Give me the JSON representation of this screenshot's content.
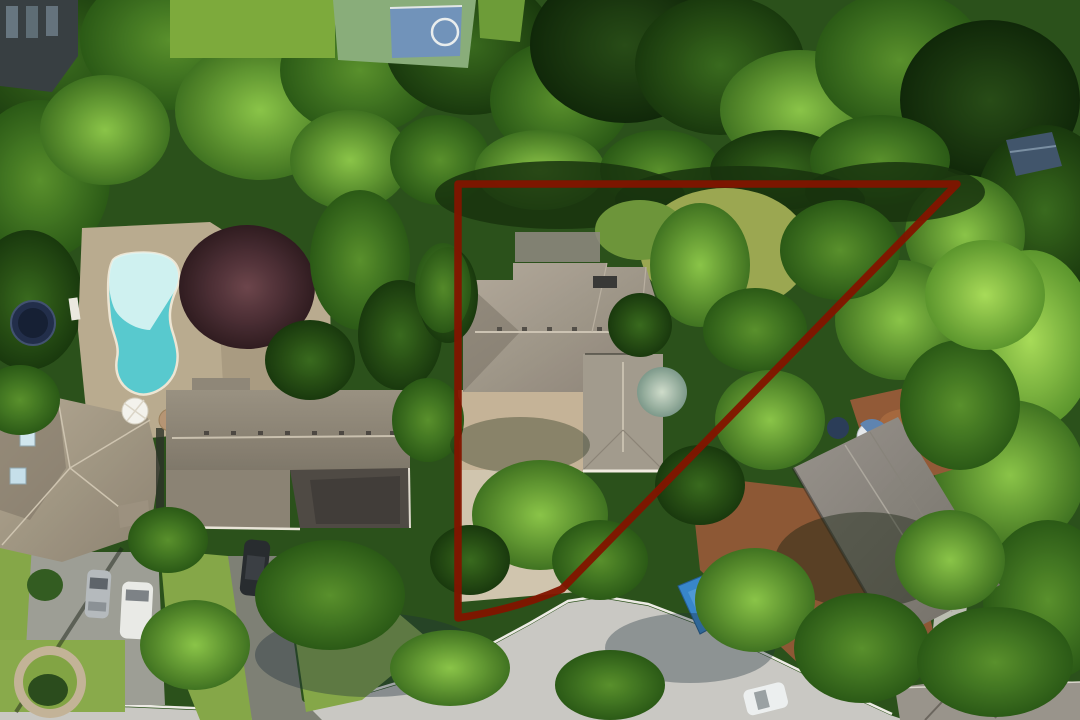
{
  "meta": {
    "description": "Aerial drone photo of a wooded suburban lot with a red property-boundary outline, a large grey-roof house inside the outline, neighbouring houses, a swimming pool, a basketball court and a cul-de-sac street"
  },
  "palette": {
    "boundary_red": "#7d1804",
    "pool_water": "#5ec6ca",
    "pool_glare": "#daf1ef",
    "street": "#c7c6c1",
    "curb": "#eae8e2",
    "grass": "#86a54e",
    "lawn_olive": "#9aa557",
    "deck_brown": "#8f5c3c",
    "boat_tarp": "#3e85c3",
    "court_green": "#8aab7c",
    "court_blue": "#7392b6",
    "trampoline_blue": "#25304a"
  },
  "boundary": {
    "label": "property-boundary-outline",
    "path": "M458,184 L957,184 L562,589 C530,603 497,612 458,618 Z",
    "stroke_width": 7.5
  },
  "objects": {
    "subject_house": "large grey hip-roof house inside boundary",
    "neighbor_house_right": "angled grey-roof house with wood deck",
    "house_bottom_left": "beige hip-roof house with skylights",
    "ranch_house_left": "long grey ranch house",
    "pool": "kidney-shaped swimming pool",
    "basketball_court": "half court with blue key",
    "shed": "small blue-grey shed",
    "boat": "blue tarp covered boat",
    "trampoline": "dark round trampoline",
    "street": "cul-de-sac street",
    "cars": [
      "silver sedan",
      "white van",
      "dark suv",
      "white car"
    ]
  }
}
